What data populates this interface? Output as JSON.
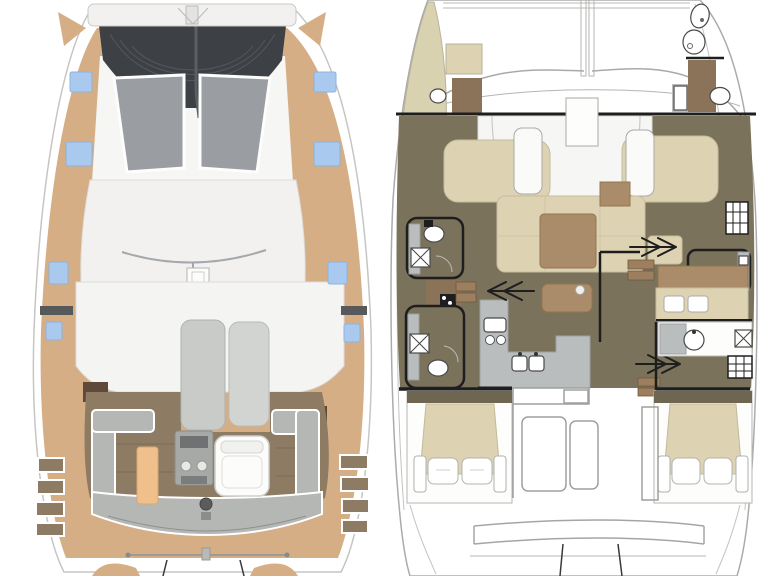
{
  "image": {
    "kind": "catamaran-floorplan",
    "panels": 2,
    "background": "#ffffff"
  },
  "colors": {
    "deck_tan": "#d6ae85",
    "tramp_dark": "#3d4044",
    "tramp_texture": "#54575b",
    "hatch_blue": "#a9c9ef",
    "hull_white": "#ffffff",
    "superstructure_white": "#f2f1ef",
    "windows_base_white": "#f6f6f4",
    "window_gray": "#9a9da2",
    "sunroof_gray": "#c9cbc9",
    "sunroof_gray_light": "#d2d4d2",
    "cockpit_wood": "#8d7b64",
    "bench_gray": "#b5b7b5",
    "table_tan": "#efc08b",
    "helm_white": "#fcfcfb",
    "grill_gray": "#a7a9a7",
    "grill_dark": "#6f7173",
    "step_dark_brown": "#5f4a3a",
    "shadow_gray": "#56585a",
    "salon_olive": "#7b725c",
    "bed_beige": "#ddd2b2",
    "wood_brown": "#ab8c6a",
    "galley_gray": "#b9bdbd",
    "shower_brown": "#8a7358",
    "bow_beige": "#d9d2b1",
    "wall_black": "#1e1e1e",
    "cabin_header_olive": "#6e6650",
    "step_wood": "#9b7f5f",
    "pillow_white": "#fdfdfc",
    "hardtop_white": "#f4f4f2"
  },
  "deck_plan": {
    "name": "exterior-deck-plan",
    "side": "left",
    "hatch_count": 8,
    "features": [
      "forward-beam",
      "bow-trampoline",
      "anchor-bridle",
      "side-deck-hatches",
      "coachroof-front-windows",
      "traveler-track",
      "mast-base",
      "hardtop",
      "sunroof-panels",
      "cockpit-wood-floor",
      "u-shaped-bench",
      "cockpit-table",
      "outdoor-grill",
      "helm-seat",
      "side-boarding-steps",
      "transom-bench",
      "swim-platform-rail",
      "davits"
    ]
  },
  "interior_plan": {
    "name": "interior-layout-plan",
    "side": "right",
    "toilets": 5,
    "showers": 4,
    "beds": 3,
    "features": [
      "bow-trampoline-outline",
      "port-bow-locker",
      "starboard-bow-head",
      "forward-bulkhead",
      "salon-settees",
      "dinette-table",
      "galley-with-stove-and-sinks",
      "companionway-arrows",
      "port-hull-heads",
      "starboard-hull-head",
      "hatched-wardrobes",
      "aft-cabin-beds-with-pillows",
      "aft-cockpit-benches",
      "transom-platform",
      "davit-lines"
    ]
  }
}
